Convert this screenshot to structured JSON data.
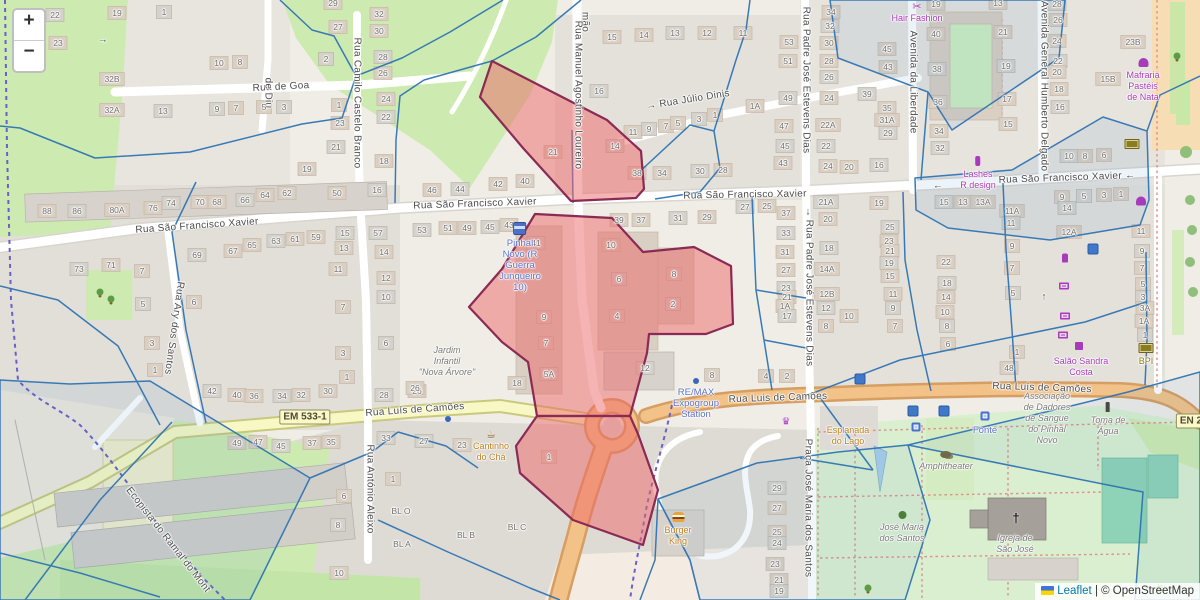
{
  "controls": {
    "zoom_in": "+",
    "zoom_out": "−"
  },
  "attribution": {
    "leaflet_label": "Leaflet",
    "separator": "|",
    "osm_label": "© OpenStreetMap"
  },
  "colors": {
    "highlight_fill": "#ed6868",
    "highlight_stroke": "#8a2a55",
    "overlay_blue": "#2f74b4",
    "park": "#cdebb0",
    "road_secondary": "#f7f8c3",
    "road_primary": "#f2c288",
    "cycleway": "#6b5fc9"
  },
  "shields": [
    {
      "t": "EM 533-1",
      "x": 305,
      "y": 417
    },
    {
      "t": "EN 2",
      "x": 1191,
      "y": 421
    }
  ],
  "streets": [
    {
      "t": "Rua de Goa",
      "x": 281,
      "y": 87,
      "r": -3
    },
    {
      "t": "de Diu",
      "x": 268,
      "y": 93,
      "v": 1
    },
    {
      "t": "mão",
      "x": 585,
      "y": 22,
      "v": 1
    },
    {
      "t": "→ Rua Júlio Dinis",
      "x": 688,
      "y": 100,
      "r": -9
    },
    {
      "t": "Rua Manuel Agostinho Loureiro",
      "x": 578,
      "y": 95,
      "v": 1
    },
    {
      "t": "Rua Camilo Castelo Branco",
      "x": 357,
      "y": 103,
      "v": 1
    },
    {
      "t": "Rua São Francisco Xavier",
      "x": 197,
      "y": 226,
      "r": -4
    },
    {
      "t": "Rua São Francisco Xavier",
      "x": 475,
      "y": 204,
      "r": -2
    },
    {
      "t": "Rua São Francisco Xavier",
      "x": 745,
      "y": 195,
      "r": -1
    },
    {
      "t": "Rua São Francisco Xavier ←",
      "x": 1067,
      "y": 178,
      "r": -2
    },
    {
      "t": "←",
      "x": 938,
      "y": 186
    },
    {
      "t": "→",
      "x": 103,
      "y": 40
    },
    {
      "t": "Rua Padre José Estevens Dias",
      "x": 806,
      "y": 80,
      "v": 1
    },
    {
      "t": "Rua Padre José Estevens Dias",
      "x": 809,
      "y": 293,
      "v": 1
    },
    {
      "t": "↓",
      "x": 808,
      "y": 212
    },
    {
      "t": "Avenida da Liberdade",
      "x": 913,
      "y": 82,
      "v": 1
    },
    {
      "t": "Avenida General Humberto Delgado",
      "x": 1044,
      "y": 86,
      "v": 1
    },
    {
      "t": "↑",
      "x": 1044,
      "y": 297
    },
    {
      "t": "Rua Ary dos Santos",
      "x": 174,
      "y": 328,
      "v": 1,
      "r": 8
    },
    {
      "t": "Rua António Aleixo",
      "x": 370,
      "y": 489,
      "v": 1
    },
    {
      "t": "Rua Luís de Camões",
      "x": 415,
      "y": 410,
      "r": -4
    },
    {
      "t": "Rua Luis de Camões",
      "x": 778,
      "y": 398,
      "r": -2
    },
    {
      "t": "Rua Luís de Camões",
      "x": 1042,
      "y": 388,
      "r": 2
    },
    {
      "t": "Ecopista do Ramal do Mont",
      "x": 168,
      "y": 540,
      "r": 52
    },
    {
      "t": "Praça José Maria dos Santos",
      "x": 808,
      "y": 508,
      "v": 1
    }
  ],
  "pois": [
    {
      "cls": "shop",
      "icon": "scissors",
      "x": 917,
      "y": 2,
      "lines": [
        "Hair Fashion"
      ]
    },
    {
      "cls": "shop",
      "icon": "cupcake",
      "x": 1143,
      "y": 58,
      "lines": [
        "Mafraria",
        "Pastéis",
        "de Nata"
      ]
    },
    {
      "cls": "shop",
      "icon": "lipstick",
      "x": 978,
      "y": 156,
      "lines": [
        "Lashes",
        "R design"
      ]
    },
    {
      "cls": "shop",
      "x": 1081,
      "y": 356,
      "lines": [
        "Salão Sandra",
        "Costa"
      ]
    },
    {
      "cls": "transit",
      "icon": "bus",
      "x": 520,
      "y": 222,
      "lines": [
        "Pinhal",
        "Novo (R",
        "Guerra",
        "Junqueiro",
        "10)"
      ]
    },
    {
      "cls": "transit",
      "icon": "dot-blue",
      "x": 696,
      "y": 376,
      "lines": [
        "RE/MAX",
        "Expogroup",
        "Station"
      ]
    },
    {
      "cls": "transit",
      "x": 985,
      "y": 425,
      "lines": [
        "Fonte"
      ]
    },
    {
      "cls": "amber",
      "icon": "cafe",
      "x": 491,
      "y": 430,
      "lines": [
        "Cantinho",
        "do Chá"
      ]
    },
    {
      "cls": "amber",
      "icon": "burger",
      "x": 678,
      "y": 512,
      "lines": [
        "Burger",
        "King"
      ]
    },
    {
      "cls": "amber",
      "icon": "drink",
      "x": 848,
      "y": 414,
      "lines": [
        "Esplanada",
        "do Lago"
      ]
    },
    {
      "cls": "olive",
      "icon": "money",
      "x": 1146,
      "y": 343,
      "lines": [
        "BPI"
      ]
    },
    {
      "cls": "place",
      "x": 447,
      "y": 345,
      "lines": [
        "Jardim",
        "Infantil",
        "\"Nova Árvore\""
      ]
    },
    {
      "cls": "place",
      "icon": "masks",
      "x": 946,
      "y": 450,
      "lines": [
        "Amphitheater"
      ]
    },
    {
      "cls": "place",
      "icon": "tree",
      "x": 902,
      "y": 511,
      "lines": [
        "José Maria",
        "dos Santos"
      ]
    },
    {
      "cls": "place",
      "x": 1015,
      "y": 533,
      "lines": [
        "Igreja de",
        "São José"
      ]
    },
    {
      "cls": "place",
      "x": 1047,
      "y": 391,
      "lines": [
        "Associação",
        "de Dadores",
        "de Sangue",
        "do Pinhal",
        "Novo"
      ]
    },
    {
      "cls": "place",
      "icon": "pump",
      "x": 1108,
      "y": 402,
      "lines": [
        "Toma de",
        "Água"
      ]
    }
  ],
  "standalone_icons": [
    {
      "n": "perfume",
      "x": 1065,
      "y": 258
    },
    {
      "n": "laptop",
      "x": 1064,
      "y": 286
    },
    {
      "n": "laptop",
      "x": 1065,
      "y": 316
    },
    {
      "n": "laptop",
      "x": 1063,
      "y": 335
    },
    {
      "n": "bar",
      "x": 1079,
      "y": 346
    },
    {
      "n": "cupcake",
      "x": 1141,
      "y": 201
    },
    {
      "n": "crown",
      "x": 786,
      "y": 422
    },
    {
      "n": "plant",
      "x": 1177,
      "y": 56
    },
    {
      "n": "money",
      "x": 1132,
      "y": 144
    },
    {
      "n": "bluesq",
      "x": 913,
      "y": 411
    },
    {
      "n": "bluesq",
      "x": 944,
      "y": 411
    },
    {
      "n": "fountain",
      "x": 916,
      "y": 427
    },
    {
      "n": "fountain",
      "x": 985,
      "y": 416
    },
    {
      "n": "bluesq",
      "x": 860,
      "y": 379
    },
    {
      "n": "bluesq",
      "x": 1093,
      "y": 249
    },
    {
      "n": "dot-blue",
      "x": 448,
      "y": 419
    },
    {
      "n": "cross",
      "x": 1016,
      "y": 518
    },
    {
      "n": "plant",
      "x": 100,
      "y": 292
    },
    {
      "n": "plant",
      "x": 111,
      "y": 299
    },
    {
      "n": "plant",
      "x": 868,
      "y": 588
    },
    {
      "n": "plant",
      "x": 1160,
      "y": 588
    }
  ],
  "house_numbers": [
    [
      55,
      15,
      "22"
    ],
    [
      58,
      43,
      "23"
    ],
    [
      117,
      13,
      "19"
    ],
    [
      164,
      12,
      "1"
    ],
    [
      112,
      79,
      "32B"
    ],
    [
      112,
      110,
      "32A"
    ],
    [
      163,
      111,
      "13"
    ],
    [
      219,
      63,
      "10"
    ],
    [
      240,
      62,
      "8"
    ],
    [
      217,
      109,
      "9"
    ],
    [
      236,
      108,
      "7"
    ],
    [
      264,
      107,
      "5"
    ],
    [
      284,
      107,
      "3"
    ],
    [
      333,
      3,
      "29"
    ],
    [
      338,
      27,
      "27"
    ],
    [
      326,
      59,
      "2"
    ],
    [
      379,
      14,
      "32"
    ],
    [
      379,
      31,
      "30"
    ],
    [
      383,
      57,
      "28"
    ],
    [
      383,
      73,
      "26"
    ],
    [
      386,
      99,
      "24"
    ],
    [
      386,
      117,
      "22"
    ],
    [
      339,
      105,
      "1"
    ],
    [
      340,
      123,
      "23"
    ],
    [
      336,
      147,
      "21"
    ],
    [
      307,
      169,
      "19"
    ],
    [
      384,
      161,
      "18"
    ],
    [
      377,
      190,
      "16"
    ],
    [
      337,
      193,
      "50"
    ],
    [
      47,
      211,
      "88"
    ],
    [
      77,
      211,
      "86"
    ],
    [
      117,
      210,
      "80A"
    ],
    [
      153,
      208,
      "76"
    ],
    [
      171,
      203,
      "74"
    ],
    [
      200,
      202,
      "70"
    ],
    [
      217,
      202,
      "68"
    ],
    [
      245,
      200,
      "66"
    ],
    [
      265,
      195,
      "64"
    ],
    [
      287,
      193,
      "62"
    ],
    [
      79,
      269,
      "73"
    ],
    [
      111,
      265,
      "71"
    ],
    [
      142,
      271,
      "7"
    ],
    [
      143,
      304,
      "5"
    ],
    [
      152,
      343,
      "3"
    ],
    [
      155,
      370,
      "1"
    ],
    [
      197,
      255,
      "69"
    ],
    [
      233,
      251,
      "67"
    ],
    [
      252,
      245,
      "65"
    ],
    [
      276,
      241,
      "63"
    ],
    [
      295,
      239,
      "61"
    ],
    [
      316,
      237,
      "59"
    ],
    [
      345,
      233,
      "15"
    ],
    [
      344,
      248,
      "13"
    ],
    [
      338,
      269,
      "11"
    ],
    [
      378,
      233,
      "57"
    ],
    [
      384,
      252,
      "14"
    ],
    [
      386,
      278,
      "12"
    ],
    [
      386,
      297,
      "10"
    ],
    [
      343,
      307,
      "7"
    ],
    [
      194,
      302,
      "6"
    ],
    [
      386,
      343,
      "6"
    ],
    [
      343,
      353,
      "3"
    ],
    [
      347,
      377,
      "1"
    ],
    [
      212,
      391,
      "42"
    ],
    [
      237,
      395,
      "40"
    ],
    [
      254,
      396,
      "36"
    ],
    [
      282,
      396,
      "34"
    ],
    [
      301,
      395,
      "32"
    ],
    [
      328,
      391,
      "30"
    ],
    [
      384,
      395,
      "28"
    ],
    [
      612,
      37,
      "15"
    ],
    [
      644,
      35,
      "14"
    ],
    [
      675,
      33,
      "13"
    ],
    [
      707,
      33,
      "12"
    ],
    [
      743,
      33,
      "11"
    ],
    [
      599,
      91,
      "16"
    ],
    [
      789,
      42,
      "53"
    ],
    [
      788,
      61,
      "51"
    ],
    [
      788,
      98,
      "49"
    ],
    [
      755,
      106,
      "1A"
    ],
    [
      784,
      126,
      "47"
    ],
    [
      785,
      146,
      "45"
    ],
    [
      783,
      163,
      "43"
    ],
    [
      633,
      132,
      "11"
    ],
    [
      649,
      129,
      "9"
    ],
    [
      666,
      126,
      "7"
    ],
    [
      678,
      123,
      "5"
    ],
    [
      699,
      119,
      "3"
    ],
    [
      715,
      115,
      "1"
    ],
    [
      553,
      152,
      "21"
    ],
    [
      615,
      146,
      "14"
    ],
    [
      637,
      173,
      "38"
    ],
    [
      662,
      173,
      "34"
    ],
    [
      700,
      171,
      "30"
    ],
    [
      723,
      170,
      "28"
    ],
    [
      432,
      190,
      "46"
    ],
    [
      460,
      189,
      "44"
    ],
    [
      498,
      184,
      "42"
    ],
    [
      525,
      181,
      "40"
    ],
    [
      745,
      207,
      "27"
    ],
    [
      767,
      206,
      "25"
    ],
    [
      831,
      12,
      "34"
    ],
    [
      830,
      26,
      "32"
    ],
    [
      829,
      43,
      "30"
    ],
    [
      829,
      61,
      "28"
    ],
    [
      829,
      77,
      "26"
    ],
    [
      829,
      98,
      "24"
    ],
    [
      828,
      125,
      "22A"
    ],
    [
      826,
      146,
      "22"
    ],
    [
      828,
      166,
      "24"
    ],
    [
      849,
      167,
      "20"
    ],
    [
      879,
      165,
      "16"
    ],
    [
      887,
      49,
      "45"
    ],
    [
      888,
      67,
      "43"
    ],
    [
      867,
      94,
      "39"
    ],
    [
      887,
      108,
      "35"
    ],
    [
      887,
      120,
      "31A"
    ],
    [
      888,
      133,
      "29"
    ],
    [
      936,
      4,
      "19"
    ],
    [
      936,
      34,
      "40"
    ],
    [
      937,
      69,
      "38"
    ],
    [
      938,
      102,
      "36"
    ],
    [
      939,
      131,
      "34"
    ],
    [
      940,
      148,
      "32"
    ],
    [
      998,
      3,
      "13"
    ],
    [
      1003,
      32,
      "21"
    ],
    [
      1006,
      66,
      "19"
    ],
    [
      1007,
      99,
      "17"
    ],
    [
      1008,
      124,
      "15"
    ],
    [
      1057,
      4,
      "28"
    ],
    [
      1058,
      20,
      "26"
    ],
    [
      1057,
      41,
      "24"
    ],
    [
      1058,
      61,
      "22"
    ],
    [
      1057,
      72,
      "20"
    ],
    [
      1059,
      89,
      "18"
    ],
    [
      1060,
      107,
      "16"
    ],
    [
      1133,
      42,
      "23B"
    ],
    [
      1108,
      79,
      "15B"
    ],
    [
      1069,
      156,
      "10"
    ],
    [
      1085,
      156,
      "8"
    ],
    [
      1104,
      155,
      "6"
    ],
    [
      944,
      202,
      "15"
    ],
    [
      963,
      202,
      "13"
    ],
    [
      983,
      202,
      "13A"
    ],
    [
      826,
      202,
      "21A"
    ],
    [
      879,
      203,
      "19"
    ],
    [
      1062,
      197,
      "9"
    ],
    [
      1084,
      196,
      "5"
    ],
    [
      1104,
      195,
      "3"
    ],
    [
      1121,
      194,
      "1"
    ],
    [
      536,
      243,
      "41"
    ],
    [
      619,
      220,
      "39"
    ],
    [
      641,
      220,
      "37"
    ],
    [
      678,
      218,
      "31"
    ],
    [
      707,
      217,
      "29"
    ],
    [
      611,
      245,
      "10"
    ],
    [
      619,
      279,
      "6"
    ],
    [
      617,
      316,
      "4"
    ],
    [
      674,
      274,
      "8"
    ],
    [
      673,
      304,
      "2"
    ],
    [
      544,
      317,
      "9"
    ],
    [
      546,
      343,
      "7"
    ],
    [
      549,
      374,
      "5A"
    ],
    [
      517,
      383,
      "18"
    ],
    [
      417,
      391,
      "26"
    ],
    [
      645,
      368,
      "12"
    ],
    [
      712,
      375,
      "8"
    ],
    [
      786,
      213,
      "37"
    ],
    [
      786,
      233,
      "33"
    ],
    [
      785,
      252,
      "31"
    ],
    [
      786,
      270,
      "27"
    ],
    [
      786,
      288,
      "23"
    ],
    [
      787,
      297,
      "21"
    ],
    [
      785,
      306,
      "1A"
    ],
    [
      787,
      316,
      "17"
    ],
    [
      766,
      376,
      "4"
    ],
    [
      787,
      376,
      "2"
    ],
    [
      422,
      230,
      "53"
    ],
    [
      448,
      228,
      "51"
    ],
    [
      467,
      228,
      "49"
    ],
    [
      490,
      227,
      "45"
    ],
    [
      509,
      225,
      "43"
    ],
    [
      828,
      219,
      "20"
    ],
    [
      829,
      248,
      "18"
    ],
    [
      827,
      269,
      "14A"
    ],
    [
      827,
      294,
      "12B"
    ],
    [
      826,
      308,
      "12"
    ],
    [
      849,
      316,
      "10"
    ],
    [
      826,
      326,
      "8"
    ],
    [
      890,
      227,
      "25"
    ],
    [
      889,
      241,
      "23"
    ],
    [
      890,
      251,
      "21"
    ],
    [
      889,
      263,
      "19"
    ],
    [
      890,
      276,
      "15"
    ],
    [
      893,
      294,
      "11"
    ],
    [
      893,
      308,
      "9"
    ],
    [
      895,
      326,
      "7"
    ],
    [
      946,
      262,
      "22"
    ],
    [
      947,
      283,
      "18"
    ],
    [
      946,
      297,
      "14"
    ],
    [
      945,
      312,
      "10"
    ],
    [
      947,
      326,
      "8"
    ],
    [
      948,
      344,
      "6"
    ],
    [
      1012,
      211,
      "11A"
    ],
    [
      1011,
      223,
      "11"
    ],
    [
      1012,
      246,
      "9"
    ],
    [
      1012,
      268,
      "7"
    ],
    [
      1013,
      293,
      "5"
    ],
    [
      1017,
      352,
      "1"
    ],
    [
      1009,
      368,
      "48"
    ],
    [
      1067,
      208,
      "14"
    ],
    [
      1069,
      232,
      "12A"
    ],
    [
      1141,
      231,
      "11"
    ],
    [
      1142,
      251,
      "9"
    ],
    [
      1142,
      268,
      "7"
    ],
    [
      1143,
      284,
      "5"
    ],
    [
      1143,
      297,
      "3"
    ],
    [
      1145,
      308,
      "3A"
    ],
    [
      1144,
      321,
      "1A"
    ],
    [
      1145,
      335,
      "1"
    ],
    [
      237,
      443,
      "49"
    ],
    [
      258,
      442,
      "47"
    ],
    [
      281,
      446,
      "45"
    ],
    [
      312,
      443,
      "37"
    ],
    [
      331,
      442,
      "35"
    ],
    [
      386,
      438,
      "33"
    ],
    [
      393,
      479,
      "1"
    ],
    [
      344,
      496,
      "6"
    ],
    [
      338,
      525,
      "8"
    ],
    [
      339,
      573,
      "10"
    ],
    [
      415,
      388,
      "26"
    ],
    [
      424,
      441,
      "27"
    ],
    [
      462,
      445,
      "23"
    ],
    [
      549,
      457,
      "1"
    ],
    [
      777,
      488,
      "29"
    ],
    [
      777,
      508,
      "27"
    ],
    [
      777,
      532,
      "25"
    ],
    [
      777,
      543,
      "24"
    ],
    [
      775,
      564,
      "23"
    ],
    [
      779,
      580,
      "21"
    ],
    [
      779,
      591,
      "19"
    ],
    [
      401,
      511,
      "BL O"
    ],
    [
      402,
      544,
      "BL A"
    ],
    [
      466,
      535,
      "BL B"
    ],
    [
      517,
      527,
      "BL C"
    ]
  ]
}
